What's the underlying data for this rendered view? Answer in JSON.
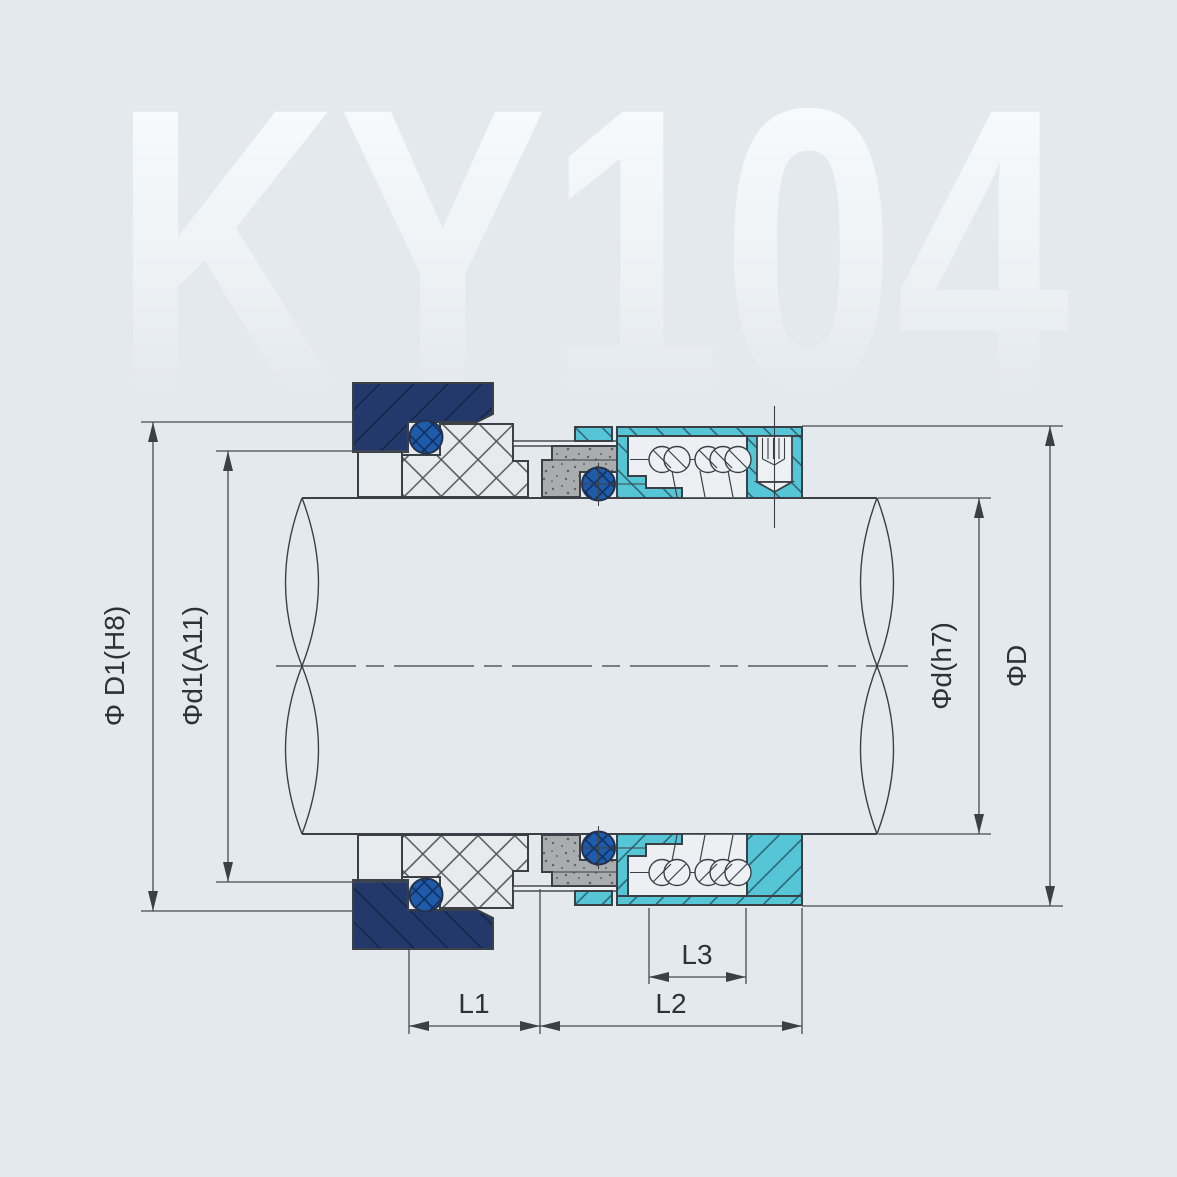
{
  "watermark": {
    "text": "KY104"
  },
  "dimensions": {
    "d1_outer_label": "Φ D1(H8)",
    "d1_inner_label": "Φd1(A11)",
    "shaft_label": "Φd(h7)",
    "outer_label": "ΦD",
    "l1_label": "L1",
    "l2_label": "L2",
    "l3_label": "L3"
  },
  "colors": {
    "background": "#e4e9ed",
    "navy": "#24396b",
    "blue_oring": "#1e5cab",
    "teal": "#56c6d6",
    "gray_face": "#aaacae",
    "white_part": "#e9eaeb",
    "cavity": "#edf0f2",
    "line": "#3a4046"
  }
}
